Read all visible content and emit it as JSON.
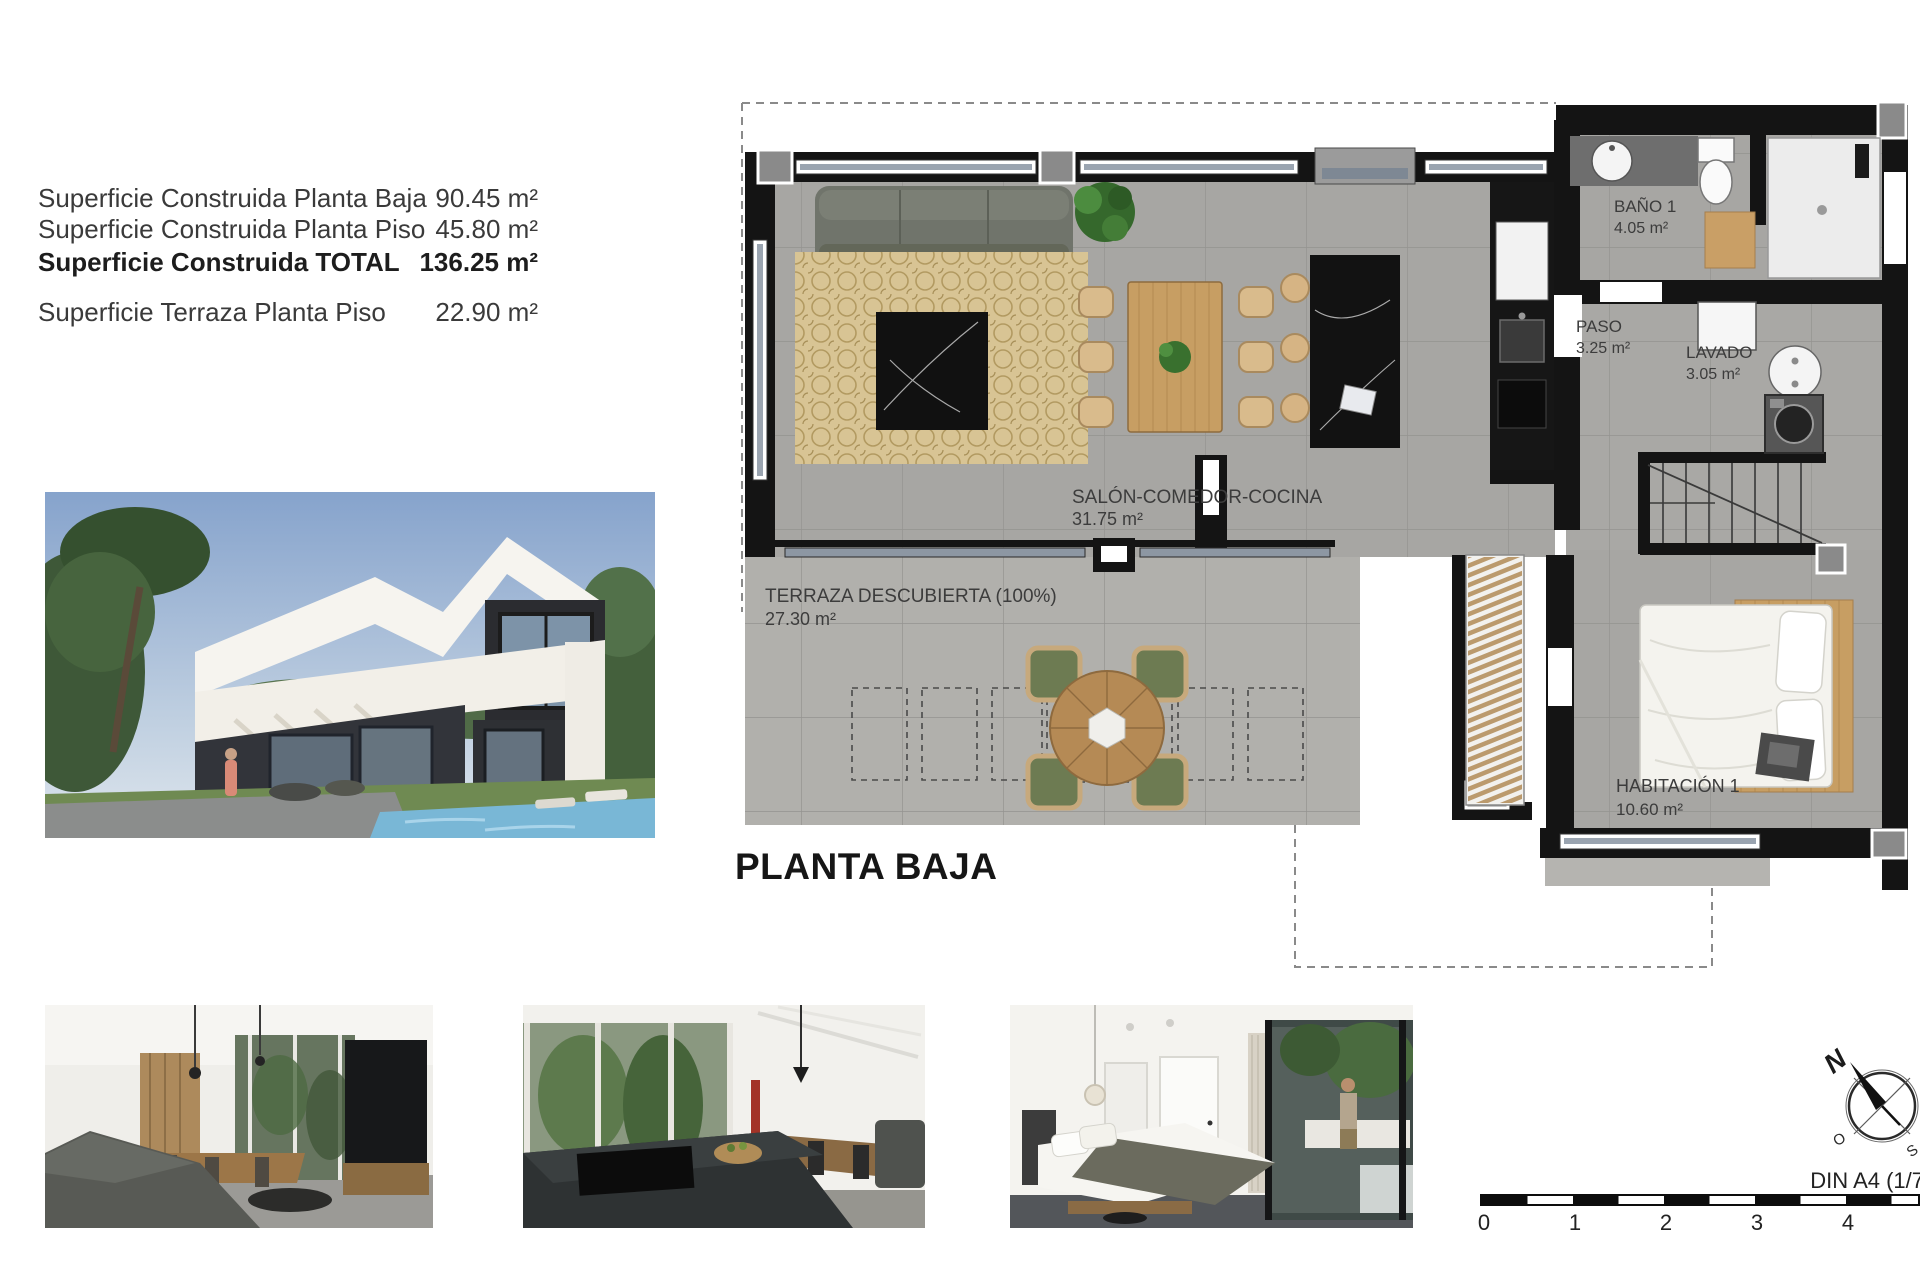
{
  "surface_table": {
    "rows": [
      {
        "label": "Superficie Construida Planta Baja",
        "value": "90.45 m²"
      },
      {
        "label": "Superficie Construida Planta Piso",
        "value": "45.80 m²"
      },
      {
        "label": "Superficie Construida TOTAL",
        "value": "136.25 m²"
      },
      {
        "label": "Superficie Terraza Planta Piso",
        "value": "22.90 m²"
      }
    ]
  },
  "plan": {
    "title": "PLANTA BAJA",
    "rooms": {
      "salon": {
        "name": "SALÓN-COMEDOR-COCINA",
        "area": "31.75 m²"
      },
      "terraza": {
        "name": "TERRAZA DESCUBIERTA (100%)",
        "area": "27.30 m²"
      },
      "bano": {
        "name": "BAÑO 1",
        "area": "4.05 m²"
      },
      "paso": {
        "name": "PASO",
        "area": "3.25 m²"
      },
      "lavado": {
        "name": "LAVADO",
        "area": "3.05 m²"
      },
      "habitacion": {
        "name": "HABITACIÓN 1",
        "area": "10.60 m²"
      }
    }
  },
  "compass": {
    "north": "N",
    "west": "O",
    "south": "S"
  },
  "scalebar": {
    "ticks": [
      "0",
      "1",
      "2",
      "3",
      "4"
    ],
    "din_label": "DIN A4 (1/7"
  },
  "colors": {
    "wall": "#141414",
    "floor": "#a8a7a3",
    "rug": "#d8c494",
    "wood": "#c49a5f",
    "accent_green": "#6d7b52"
  }
}
